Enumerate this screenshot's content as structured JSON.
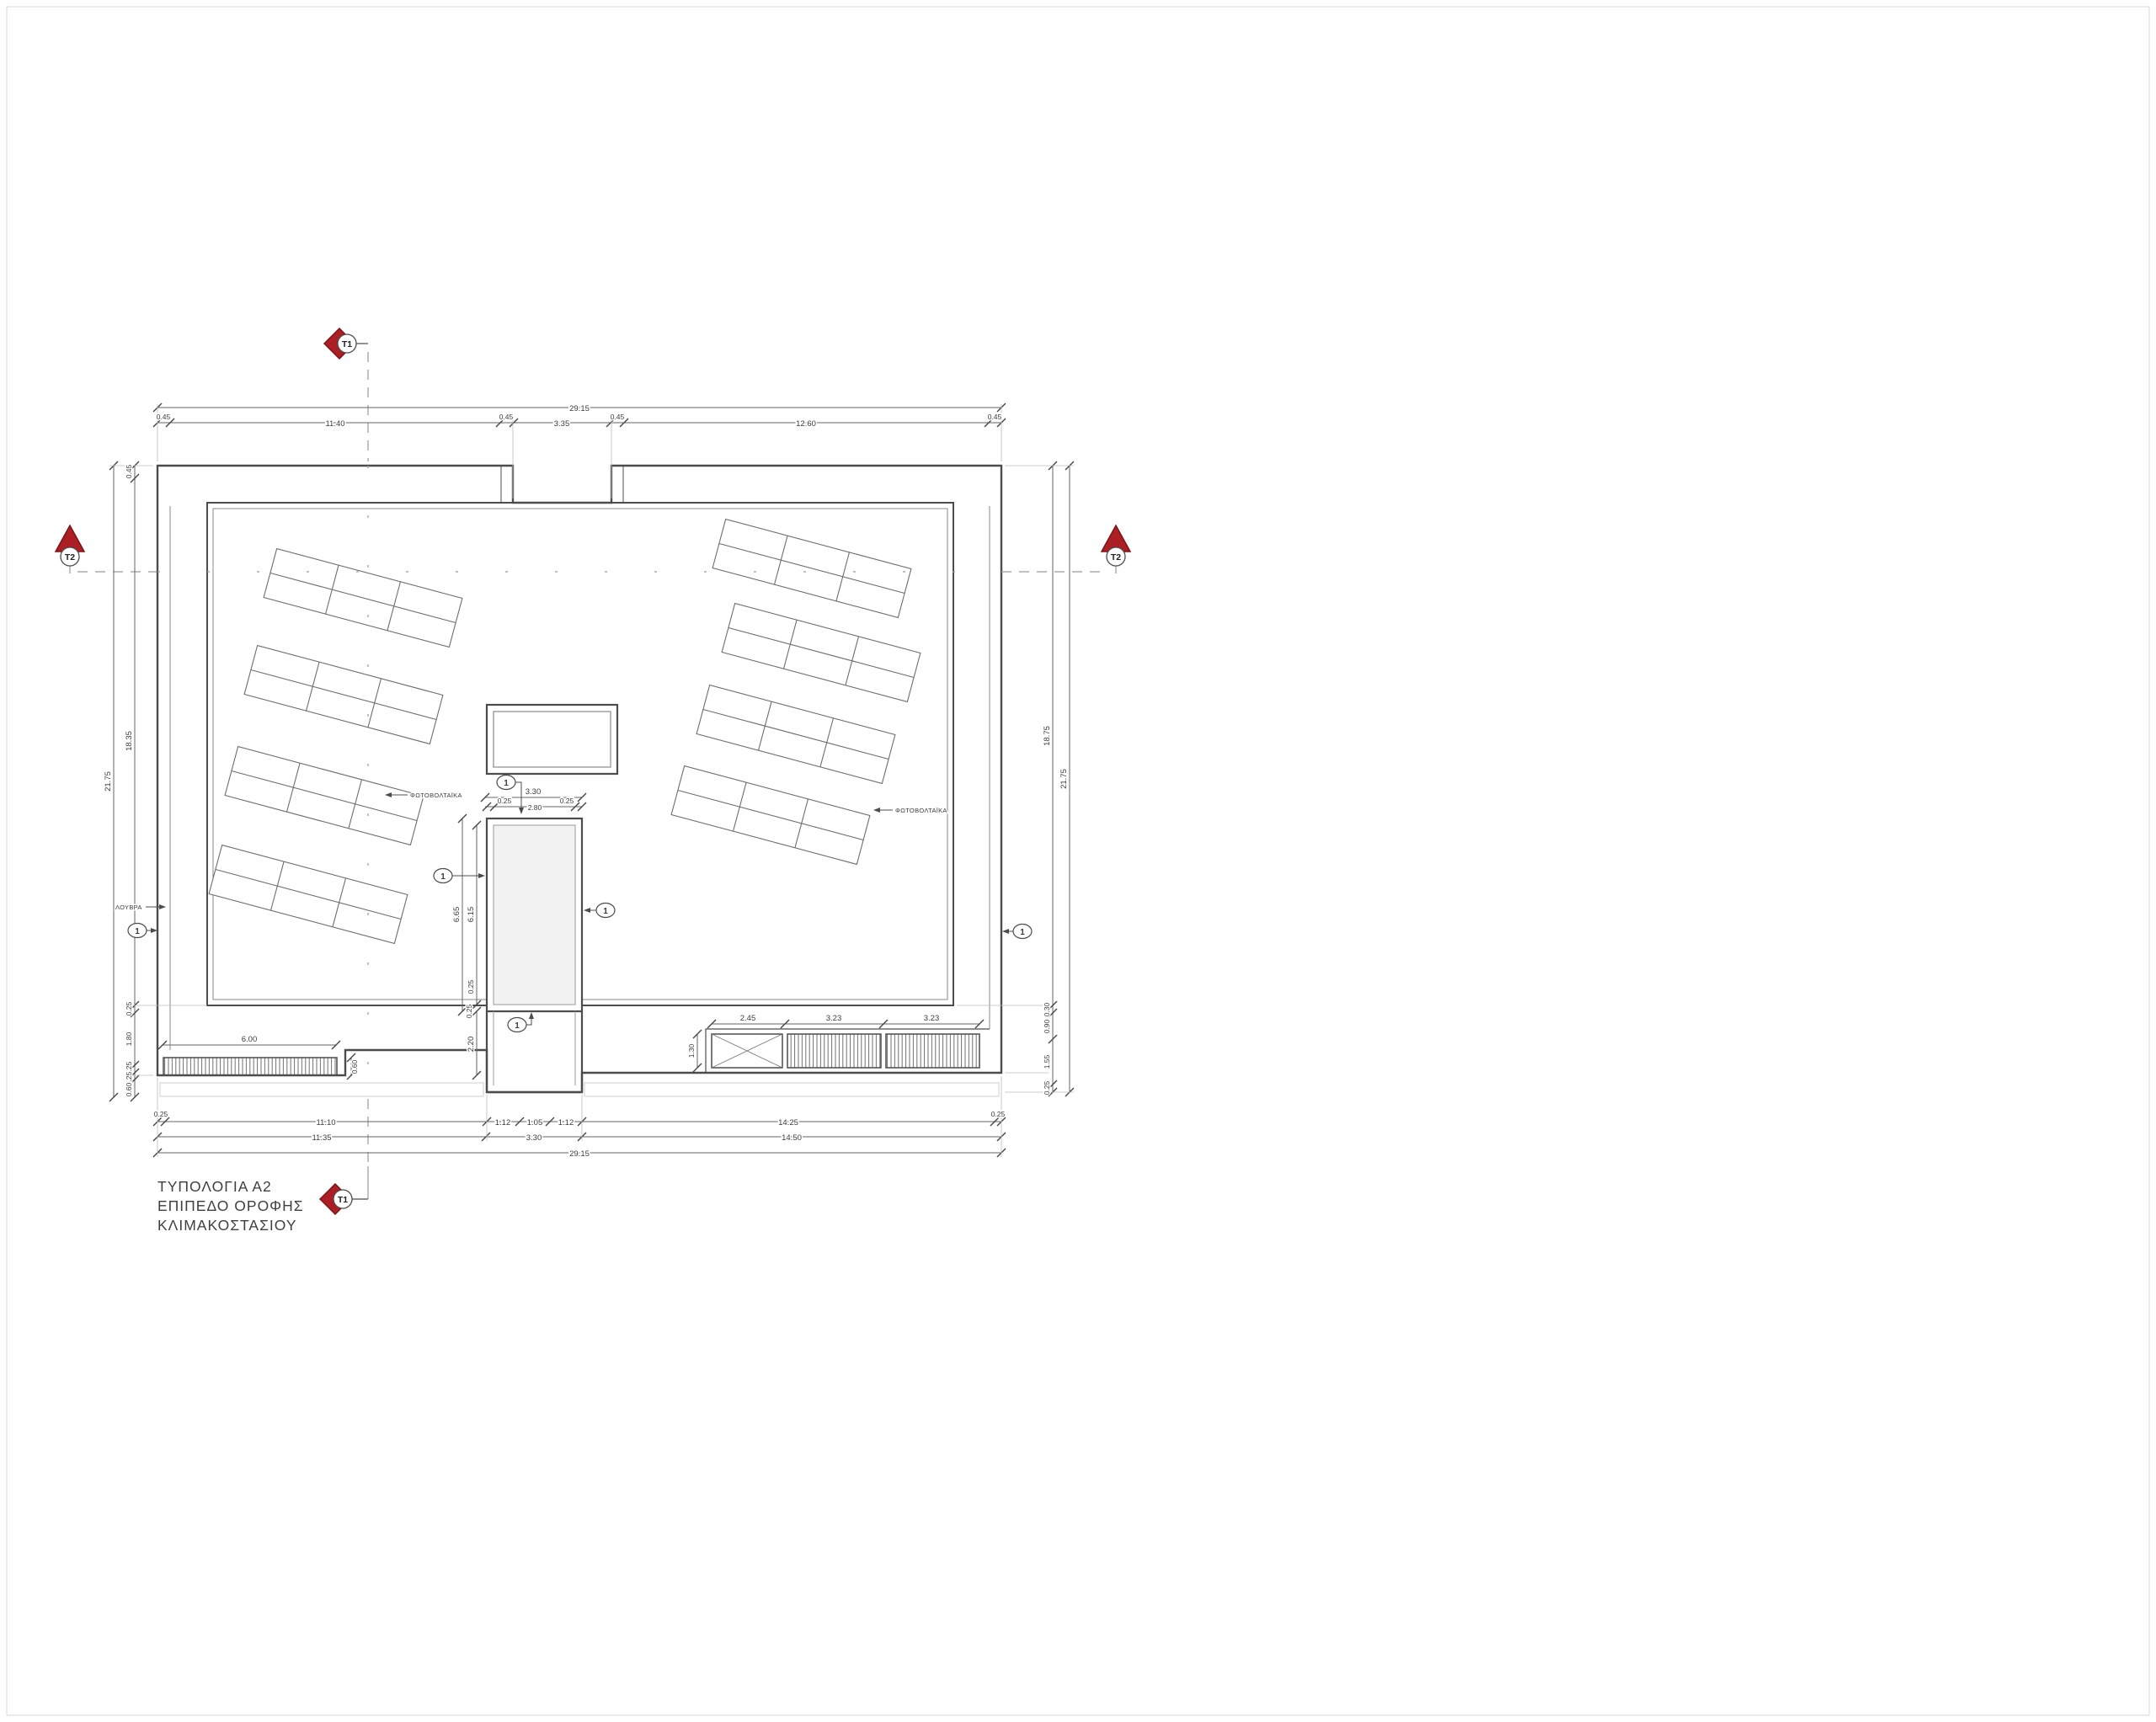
{
  "drawing_title": {
    "line1": "ΤΥΠΟΛΟΓΙΑ Α2",
    "line2": "ΕΠΙΠΕΔΟ  ΟΡΟΦΗΣ",
    "line3": "ΚΛΙΜΑΚΟΣΤΑΣΙΟΥ"
  },
  "section_markers": {
    "top": "T1",
    "bottom": "T1",
    "left": "T2",
    "right": "T2"
  },
  "callout": "1",
  "labels": {
    "louvers": "ΛΟΥΒΡΑ",
    "photovoltaics": "ΦΩΤΟΒΟΛΤΑΪΚΑ"
  },
  "colors": {
    "marker_red": "#ab1f24",
    "marker_red_edge": "#7d1418",
    "line_dark": "#4c4c4c",
    "line_light": "#9a9a9a",
    "shaft_fill": "#f2f2f2"
  },
  "dims": {
    "top_overall": "29.15",
    "top": [
      "0.45",
      "11.40",
      "0.45",
      "3.35",
      "0.45",
      "12.60",
      "0.45"
    ],
    "left_overall": "21.75",
    "left": [
      "0.45",
      "18.35",
      "0.25",
      "1.80",
      "0.25",
      "0.25",
      "0.60"
    ],
    "right_overall": "21.75",
    "right": [
      "18.75",
      "0.30",
      "0.90",
      "1.55",
      "0.25"
    ],
    "bottom1": [
      "0.25",
      "11.10",
      "1.12",
      "1.05",
      "1.12",
      "14.25",
      "0.25"
    ],
    "bottom2": [
      "11.35",
      "3.30",
      "14.50"
    ],
    "bottom_overall": "29.15",
    "stair_w": "3.30",
    "stair_w_parts": [
      "0.25",
      "2.80",
      "0.25"
    ],
    "stair_h": "6.65",
    "stair_h_inner": "6.15",
    "stair_below": [
      "0.25",
      "0.25",
      "2.20"
    ],
    "louver_len": "6.00",
    "louver_depth": "0.60",
    "equip": [
      "2.45",
      "3.23",
      "3.23"
    ],
    "equip_h": "1.30"
  }
}
